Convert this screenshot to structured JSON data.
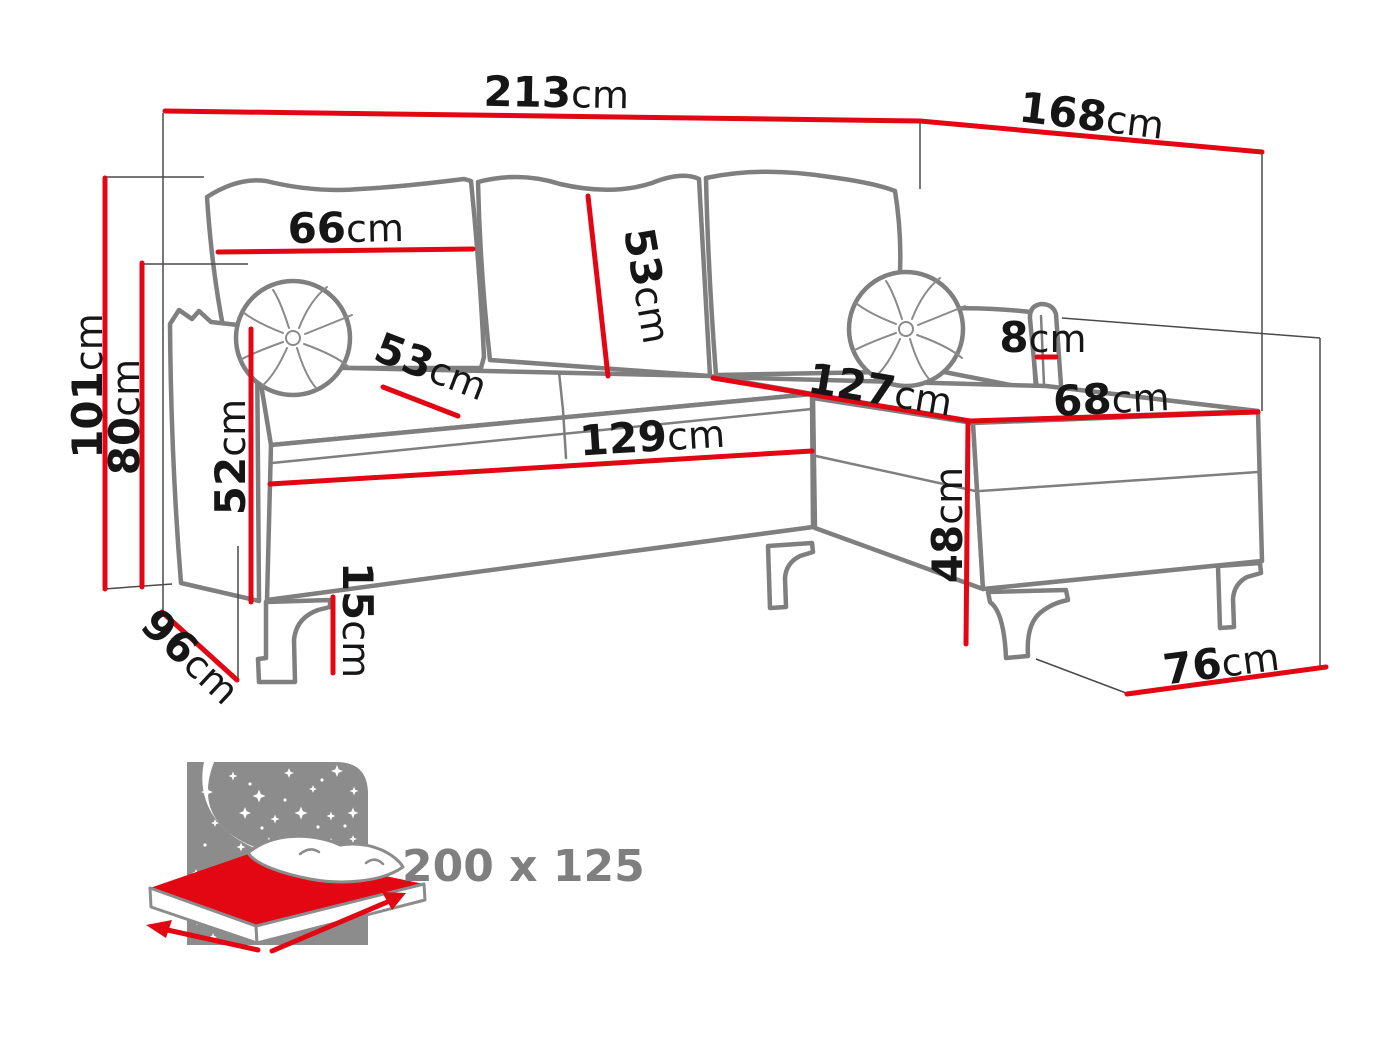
{
  "diagram": {
    "type": "corner-sofa-dimension-diagram",
    "unit": "cm",
    "colors": {
      "dimension_red": "#e30613",
      "outline_gray": "#7f7f7f",
      "label_black": "#161616",
      "icon_gray": "#8c8c8c"
    }
  },
  "dimensions": {
    "width_total": {
      "value": "213",
      "unit": "cm"
    },
    "depth_total": {
      "value": "168",
      "unit": "cm"
    },
    "height_total": {
      "value": "101",
      "unit": "cm"
    },
    "height_backrest": {
      "value": "80",
      "unit": "cm"
    },
    "back_cushion_width": {
      "value": "66",
      "unit": "cm"
    },
    "back_cushion_height": {
      "value": "53",
      "unit": "cm"
    },
    "seat_depth": {
      "value": "53",
      "unit": "cm"
    },
    "seat_width": {
      "value": "129",
      "unit": "cm"
    },
    "chaise_length": {
      "value": "127",
      "unit": "cm"
    },
    "chaise_width": {
      "value": "68",
      "unit": "cm"
    },
    "armrest_top": {
      "value": "8",
      "unit": "cm"
    },
    "armrest_height": {
      "value": "52",
      "unit": "cm"
    },
    "leg_height": {
      "value": "15",
      "unit": "cm"
    },
    "depth_base": {
      "value": "96",
      "unit": "cm"
    },
    "chaise_height": {
      "value": "48",
      "unit": "cm"
    },
    "chaise_base_width": {
      "value": "76",
      "unit": "cm"
    }
  },
  "sleeping_area": {
    "label": "200 x 125"
  }
}
